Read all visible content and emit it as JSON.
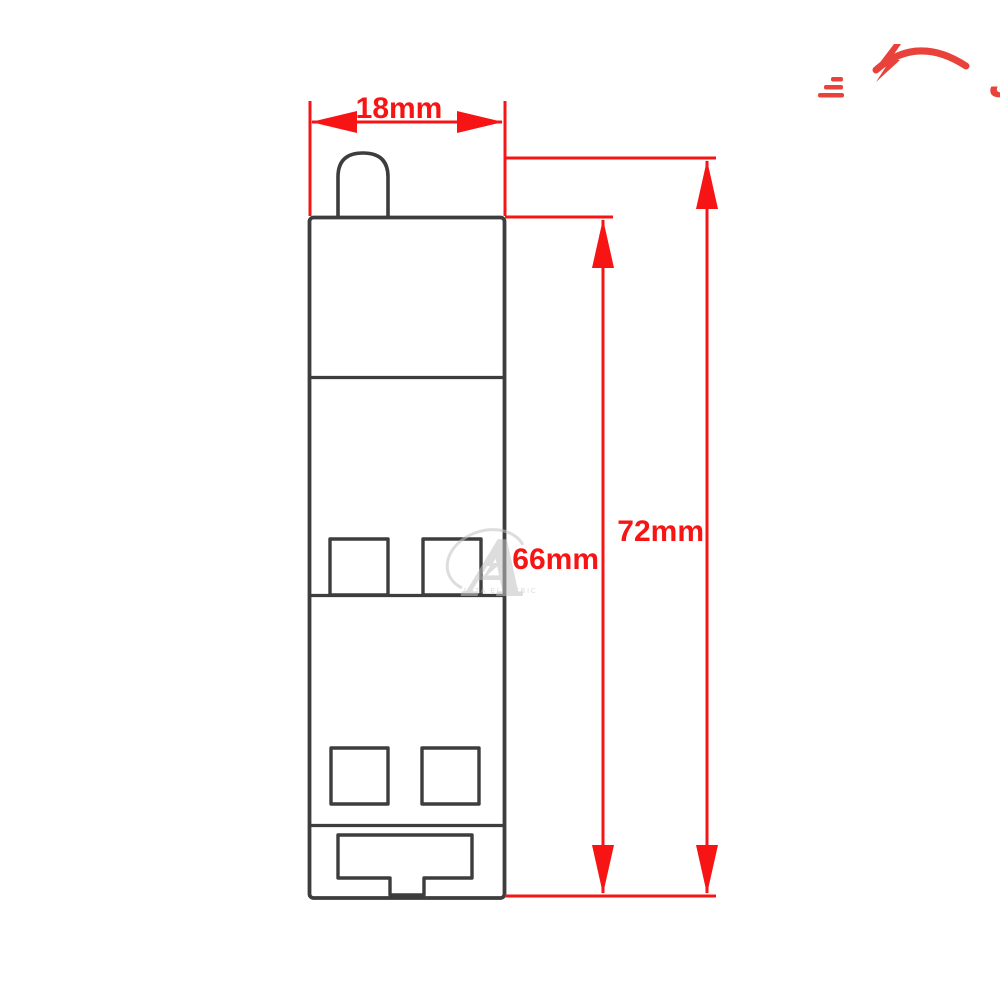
{
  "brand": {
    "name": "آرتاالکتریک",
    "color": "#e8423a",
    "icons": [
      "lightning-bolt",
      "swoosh-arc",
      "speed-lines"
    ]
  },
  "dimensions": {
    "color": "#f71414",
    "width": {
      "label": "18mm"
    },
    "body_height": {
      "label": "66mm"
    },
    "total_height": {
      "label": "72mm"
    }
  },
  "device": {
    "name": "miniature-circuit-breaker-side-outline",
    "outline_color": "#3d3d3d",
    "fill": "#ffffff",
    "parts": [
      "toggle-lever",
      "body",
      "upper-terminal-squares",
      "lower-terminal-squares",
      "din-rail-clip"
    ]
  },
  "watermark": {
    "letter": "A",
    "subtext": "ARTA ELECTRIC",
    "color": "#c2c2c2"
  },
  "background": "#ffffff"
}
